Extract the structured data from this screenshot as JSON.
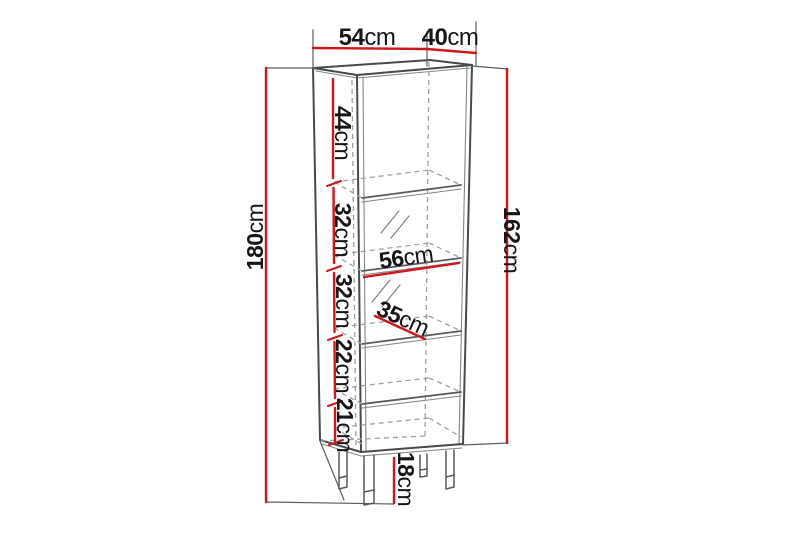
{
  "diagram": {
    "type": "furniture-dimension-diagram",
    "subject": "tall display cabinet with five shelf sections and legs",
    "colors": {
      "dimension_red": "#cd1719",
      "outline_gray": "#474b4e",
      "hidden_edge_gray": "#9ca1a4",
      "label_text": "#161616",
      "background": "#ffffff"
    },
    "dimensions": {
      "top_width": {
        "value": "54",
        "unit": "cm"
      },
      "top_depth": {
        "value": "40",
        "unit": "cm"
      },
      "total_height": {
        "value": "180",
        "unit": "cm"
      },
      "body_height": {
        "value": "162",
        "unit": "cm"
      },
      "sections": [
        {
          "value": "44",
          "unit": "cm"
        },
        {
          "value": "32",
          "unit": "cm"
        },
        {
          "value": "32",
          "unit": "cm"
        },
        {
          "value": "22",
          "unit": "cm"
        },
        {
          "value": "21",
          "unit": "cm"
        }
      ],
      "shelf_width": {
        "value": "56",
        "unit": "cm"
      },
      "shelf_depth": {
        "value": "35",
        "unit": "cm"
      },
      "leg_height": {
        "value": "18",
        "unit": "cm"
      }
    }
  }
}
